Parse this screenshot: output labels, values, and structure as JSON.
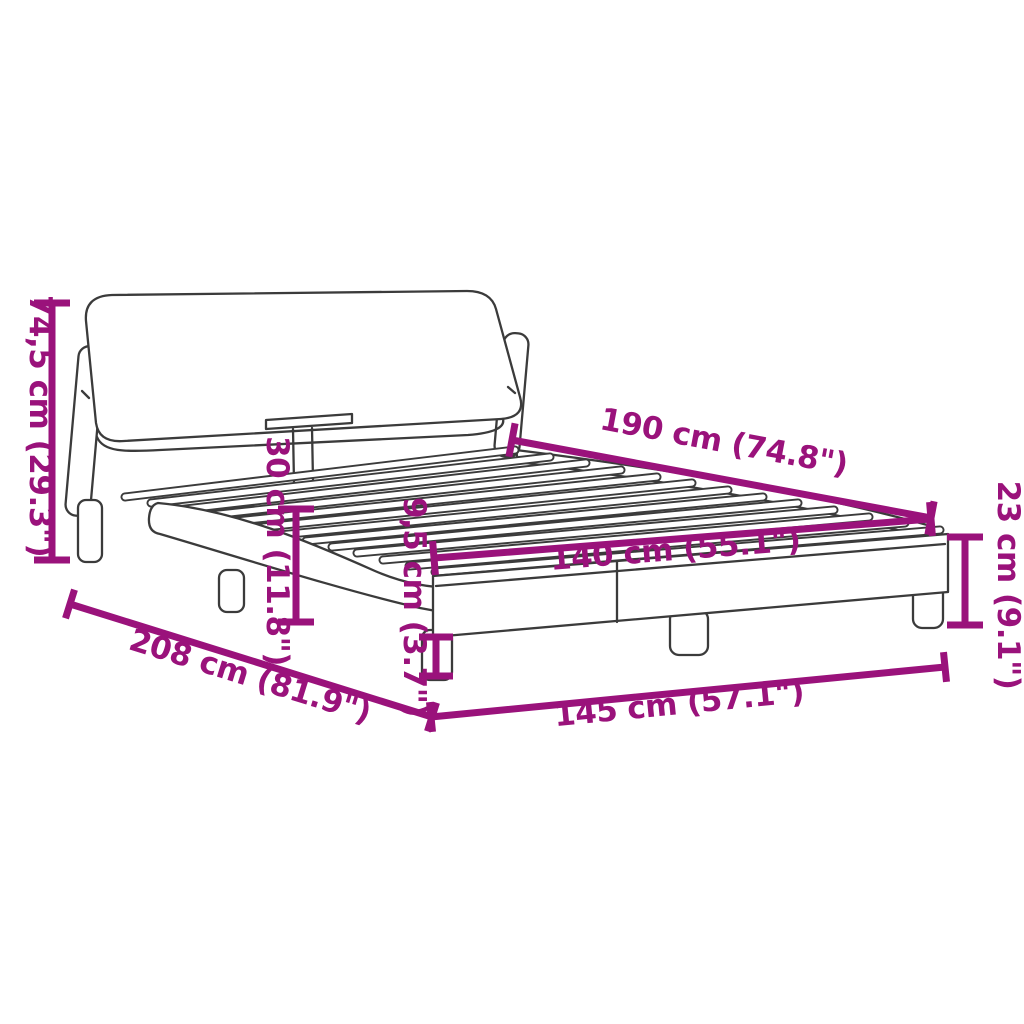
{
  "diagram": {
    "title": "bed-frame-dimension-diagram",
    "background_color": "#FFFFFF",
    "line_color": "#3B3B3B",
    "accent_color": "#9A127B",
    "dimensions": [
      {
        "id": "headboard-height",
        "label": "74,5 cm (29.3\")"
      },
      {
        "id": "slat-base-length",
        "label": "190 cm (74.8\")"
      },
      {
        "id": "side-rail-height",
        "label": "30 cm (11.8\")"
      },
      {
        "id": "footboard-frame-height",
        "label": "23 cm (9.1\")"
      },
      {
        "id": "leg-height",
        "label": "9,5 cm (3.7\")"
      },
      {
        "id": "slat-base-width",
        "label": "140 cm (55.1\")"
      },
      {
        "id": "total-length",
        "label": "208 cm (81.9\")"
      },
      {
        "id": "total-width",
        "label": "145 cm (57.1\")"
      }
    ]
  }
}
